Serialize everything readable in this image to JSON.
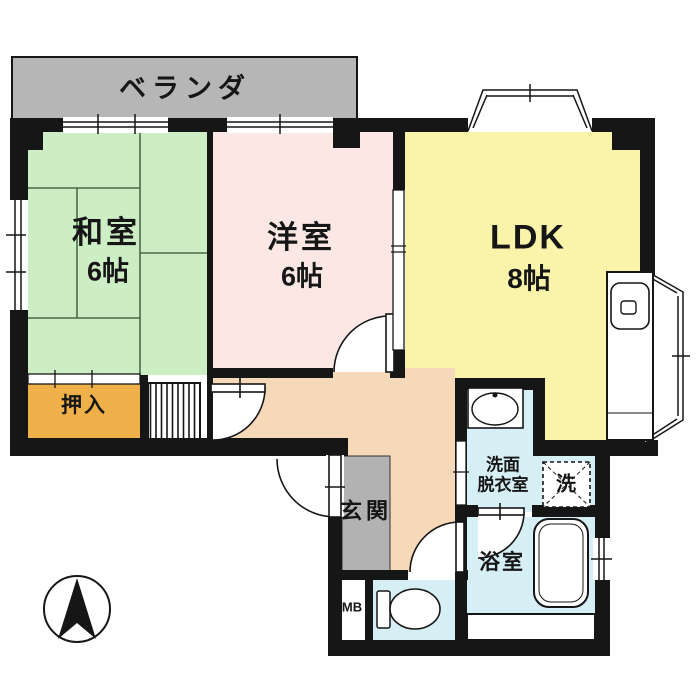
{
  "floorplan": {
    "title": "2LDK apartment floor plan",
    "rooms": {
      "veranda": {
        "label": "ベランダ"
      },
      "washitsu": {
        "label": "和室",
        "size": "6帖"
      },
      "youshitsu": {
        "label": "洋室",
        "size": "6帖"
      },
      "ldk": {
        "label": "LDK",
        "size": "8帖"
      },
      "oshiire": {
        "label": "押入"
      },
      "genkan": {
        "label": "玄関"
      },
      "washroom": {
        "label_line1": "洗面",
        "label_line2": "脱衣室"
      },
      "laundry": {
        "label": "洗"
      },
      "bathroom": {
        "label": "浴室"
      },
      "meter_box": {
        "label": "MB"
      }
    },
    "colors": {
      "washitsu": "#cdedc5",
      "tatami_line": "#4a6b45",
      "youshitsu": "#fbe8e4",
      "ldk": "#faf4ab",
      "corridor": "#f6d9b8",
      "oshiire": "#efb04a",
      "wet_area": "#d5eff5",
      "veranda": "#b6b6b6",
      "genkan": "#b2b2b2",
      "wall": "#161616"
    }
  }
}
